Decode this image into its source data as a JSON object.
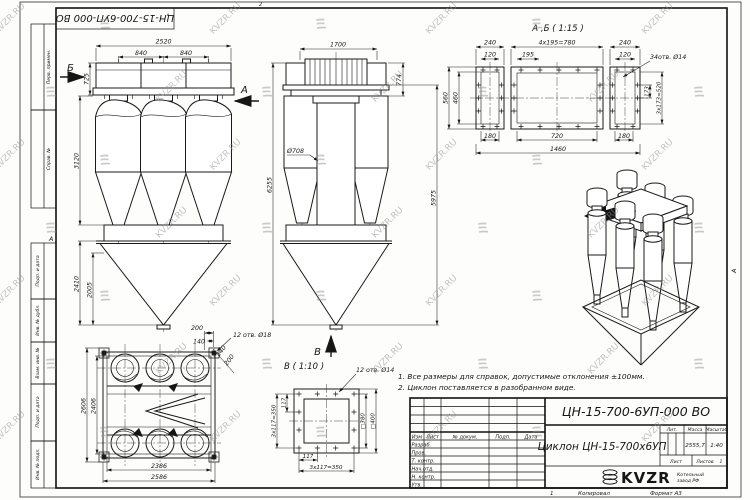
{
  "frame": {
    "top_stamp_code": "ЦН-15-700-6УП-000 ВО",
    "fold_mark_top": "2",
    "fold_mark_left": "А",
    "fold_mark_right": "А",
    "bottom_sheet_num": "1",
    "copied_label": "Копировал",
    "format_label": "Формат А3",
    "margin_labels": [
      "Перв. примен.",
      "Справ. №",
      "Подп. и дата",
      "Инв. № дубл.",
      "Взам. инв. №",
      "Подп. и дата",
      "Инв. № подл."
    ]
  },
  "watermark": {
    "text": "KVZR.RU"
  },
  "notes": {
    "line1": "1. Все размеры для справок, допустимые отклонения ±100мм.",
    "line2": "2. Циклон поставляется в разобранном виде."
  },
  "front_view": {
    "label_b": "Б",
    "label_a": "А",
    "dim_total": "2520",
    "dim_pitch_1": "840",
    "dim_pitch_2": "840",
    "dim_inlet": "725",
    "dim_body": "3120",
    "dim_hopper": "2410",
    "dim_cone": "2005"
  },
  "side_view": {
    "dim_width": "1700",
    "dim_inlet_h": "774",
    "dim_pipe_dia": "Ø708",
    "dim_total_h": "6255",
    "dim_h2": "5975",
    "label_v": "В"
  },
  "plan_view": {
    "dim_outer_h": "2606",
    "dim_inner_h": "2406",
    "dim_inner_w": "2386",
    "dim_outer_w": "2586",
    "dim_edge": "200",
    "dim_hole": "140",
    "holes_note": "12 отв. Ø18",
    "dim_diag_1": "140",
    "dim_diag_2": "200"
  },
  "detail_v": {
    "title": "В ( 1:10 )",
    "holes_note": "12 отв. Ø14",
    "dim_pitch_left": "117",
    "dim_total_left": "3x117=350",
    "dim_pitch_bottom": "117",
    "dim_total_bottom": "3x117=350",
    "dim_inner_sq": "□380",
    "dim_outer_sq": "□400"
  },
  "detail_ab": {
    "title": "А ,Б ( 1:15 )",
    "dim_240_left": "240",
    "dim_780": "4x195=780",
    "dim_240_right": "240",
    "dim_120_left": "120",
    "dim_195": "195",
    "dim_120_right": "120",
    "holes_note": "34отв. Ø14",
    "dim_560": "560",
    "dim_460": "460",
    "dim_173": "173",
    "dim_520": "3x173=520",
    "dim_180_left": "180",
    "dim_720": "720",
    "dim_180_right": "180",
    "dim_1460": "1460"
  },
  "title_block": {
    "doc_number": "ЦН-15-700-6УП-000 ВО",
    "product_name": "Циклон ЦН-15-700х6УП",
    "col_izm": "Изм",
    "col_list": "Лист",
    "col_doc": "№ докум.",
    "col_podp": "Подп.",
    "col_data": "Дата",
    "row_1": "Разраб.",
    "row_2": "Пров.",
    "row_3": "Т. контр.",
    "row_4": "Нач.отд.",
    "row_5": "Н. контр.",
    "row_6": "Утв.",
    "lit_label": "Лит.",
    "mass_label": "Масса",
    "scale_label": "Масштаб",
    "mass_value": "2555,7",
    "scale_value": "1:40",
    "sheet_label": "Лист",
    "sheets_label": "Листов",
    "sheets_value": "1",
    "logo_text": "KVZR",
    "logo_sub1": "Котельный",
    "logo_sub2": "завод РФ"
  }
}
